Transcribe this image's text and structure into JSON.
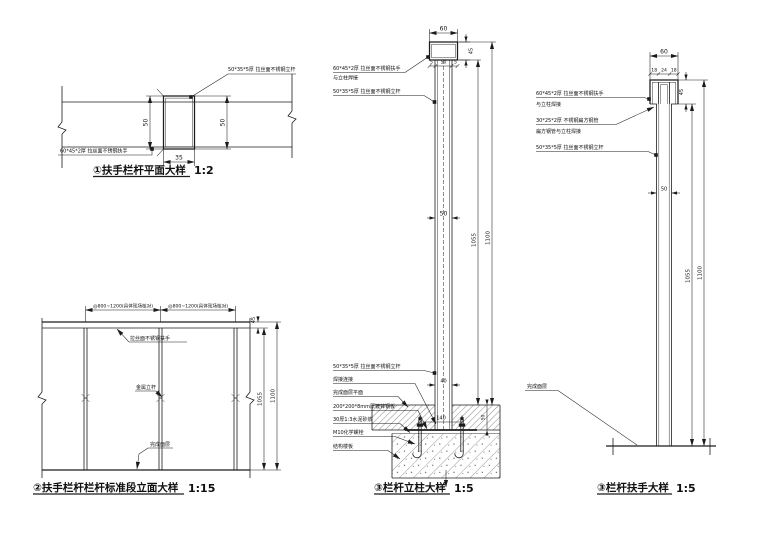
{
  "page": {
    "background": "#ffffff",
    "line_color": "#1c1c1c"
  },
  "drawings": {
    "plan": {
      "title": "①扶手栏杆平面大样",
      "scale": "1:2",
      "label_post": "50*35*5厚 拉丝面不锈钢立杆",
      "label_rail": "60*45*2厚 拉丝面不锈钢扶手",
      "dim_left": "50",
      "dim_right": "50",
      "dim_width": "35"
    },
    "elevation": {
      "title": "②扶手栏杆栏杆标准段立面大样",
      "scale": "1:15",
      "dim_bay_1": "@800~1200(具体现场核对)",
      "dim_bay_2": "@800~1200(具体现场核对)",
      "label_rail": "拉丝面不锈钢扶手",
      "label_post": "金属立杆",
      "label_floor": "完成面层",
      "dim_rail_height": "45",
      "dim_clear_height": "1055",
      "dim_total_height": "1100"
    },
    "post": {
      "title": "③栏杆立柱大样",
      "scale": "1:5",
      "label_rail_line1": "60*45*2厚 拉丝面不锈钢扶手",
      "label_rail_line2": "与立柱焊接",
      "label_post_upper": "50*35*5厚 拉丝面不锈钢立杆",
      "label_post_lower": "50*35*5厚 拉丝面不锈钢立杆",
      "label_weld": "焊接连接",
      "label_finish_level": "完成面层平面",
      "label_plate": "200*200*8mm厚镀锌钢板",
      "label_mortar": "30厚1:3水泥砂浆",
      "label_anchor": "M10化学螺栓",
      "label_slab": "结构楼板",
      "dim_rail_width": "60",
      "dim_rail_height": "45",
      "dim_cap_left": "5",
      "dim_cap_mid": "50",
      "dim_cap_right": "5",
      "dim_post_width": "50",
      "dim_clear_height": "1055",
      "dim_total_height": "1100",
      "dim_base_width": "40",
      "dim_bolt_spacing": "140",
      "dim_finish_depth": "50"
    },
    "rail": {
      "title": "③栏杆扶手大样",
      "scale": "1:5",
      "dim_rail_width": "60",
      "dims_top": [
        "18",
        "24",
        "18"
      ],
      "dim_rail_height": "45",
      "dim_post_width": "50",
      "dim_clear_height": "1055",
      "dim_total_height": "1100",
      "label_rail_line1": "60*45*2厚 拉丝面不锈钢扶手",
      "label_rail_line2": "与立柱焊接",
      "label_tube_line1": "30*25*2厚 不锈钢扁方钢管",
      "label_tube_line2": "扁方钢管与立柱焊接",
      "label_post": "50*35*5厚 拉丝面不锈钢立杆",
      "label_floor": "完成面层"
    }
  }
}
